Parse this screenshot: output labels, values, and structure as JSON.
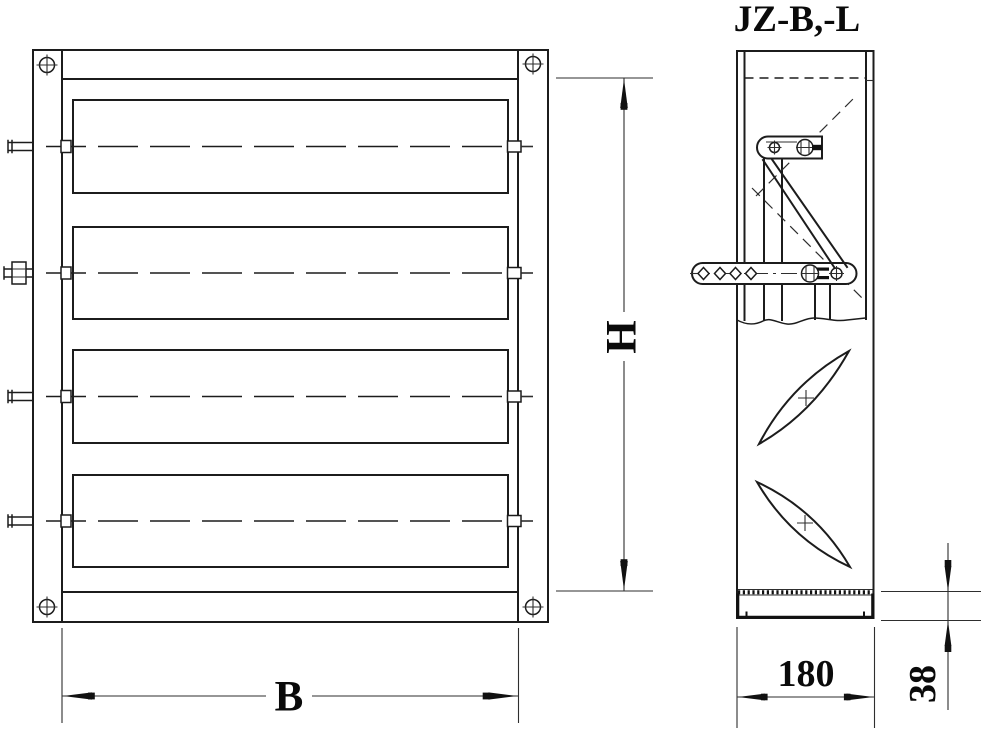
{
  "title": "JZ-B,-L",
  "front_view": {
    "width_label": "B",
    "height_label": "H",
    "blade_count": 4
  },
  "side_view": {
    "depth_label": "180",
    "bottom_frame_label": "38"
  },
  "colors": {
    "background": "#ffffff",
    "line": "#1c1c1c"
  }
}
